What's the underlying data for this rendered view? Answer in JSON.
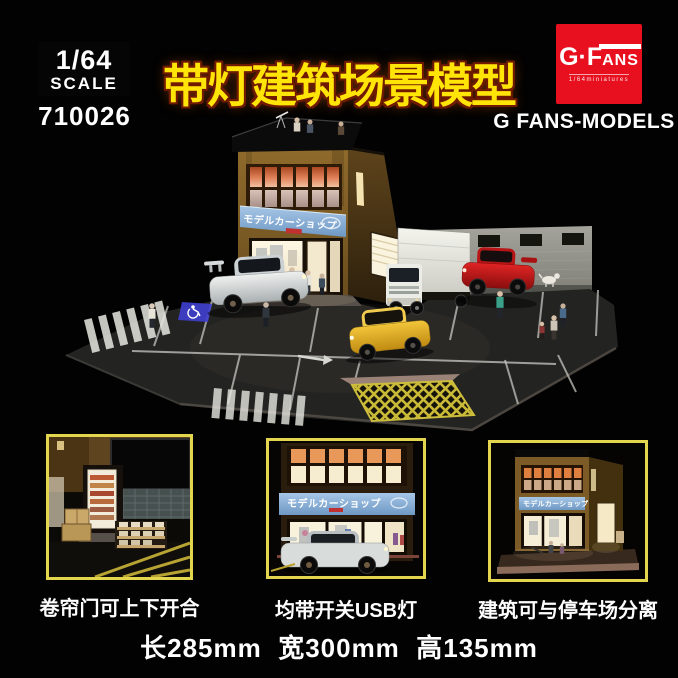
{
  "header": {
    "scale_badge": {
      "ratio": "1/64",
      "word": "SCALE"
    },
    "item_number": "710026",
    "title": "带灯建筑场景模型",
    "brand": {
      "logo_prefix": "G·F",
      "logo_suffix": "ANS",
      "logo_sub": "1/64miniatures",
      "name": "G FANS-MODELS"
    }
  },
  "scene": {
    "shop_sign": "モデルカーショップ"
  },
  "features": [
    {
      "caption": "卷帘门可上下开合"
    },
    {
      "caption": "均带开关USB灯"
    },
    {
      "caption": "建筑可与停车场分离"
    }
  ],
  "footer": {
    "dimensions": "长285mm  宽300mm  高135mm"
  },
  "colors": {
    "title_yellow": "#ffe408",
    "title_outline": "#701a00",
    "brand_red": "#e8101e",
    "thumb_border": "#e3d54d",
    "building_brown": "#8f6a2c",
    "window_glow": "#e0825a",
    "sign_blue": "#8fb6dc",
    "lot_asphalt": "#232321"
  }
}
